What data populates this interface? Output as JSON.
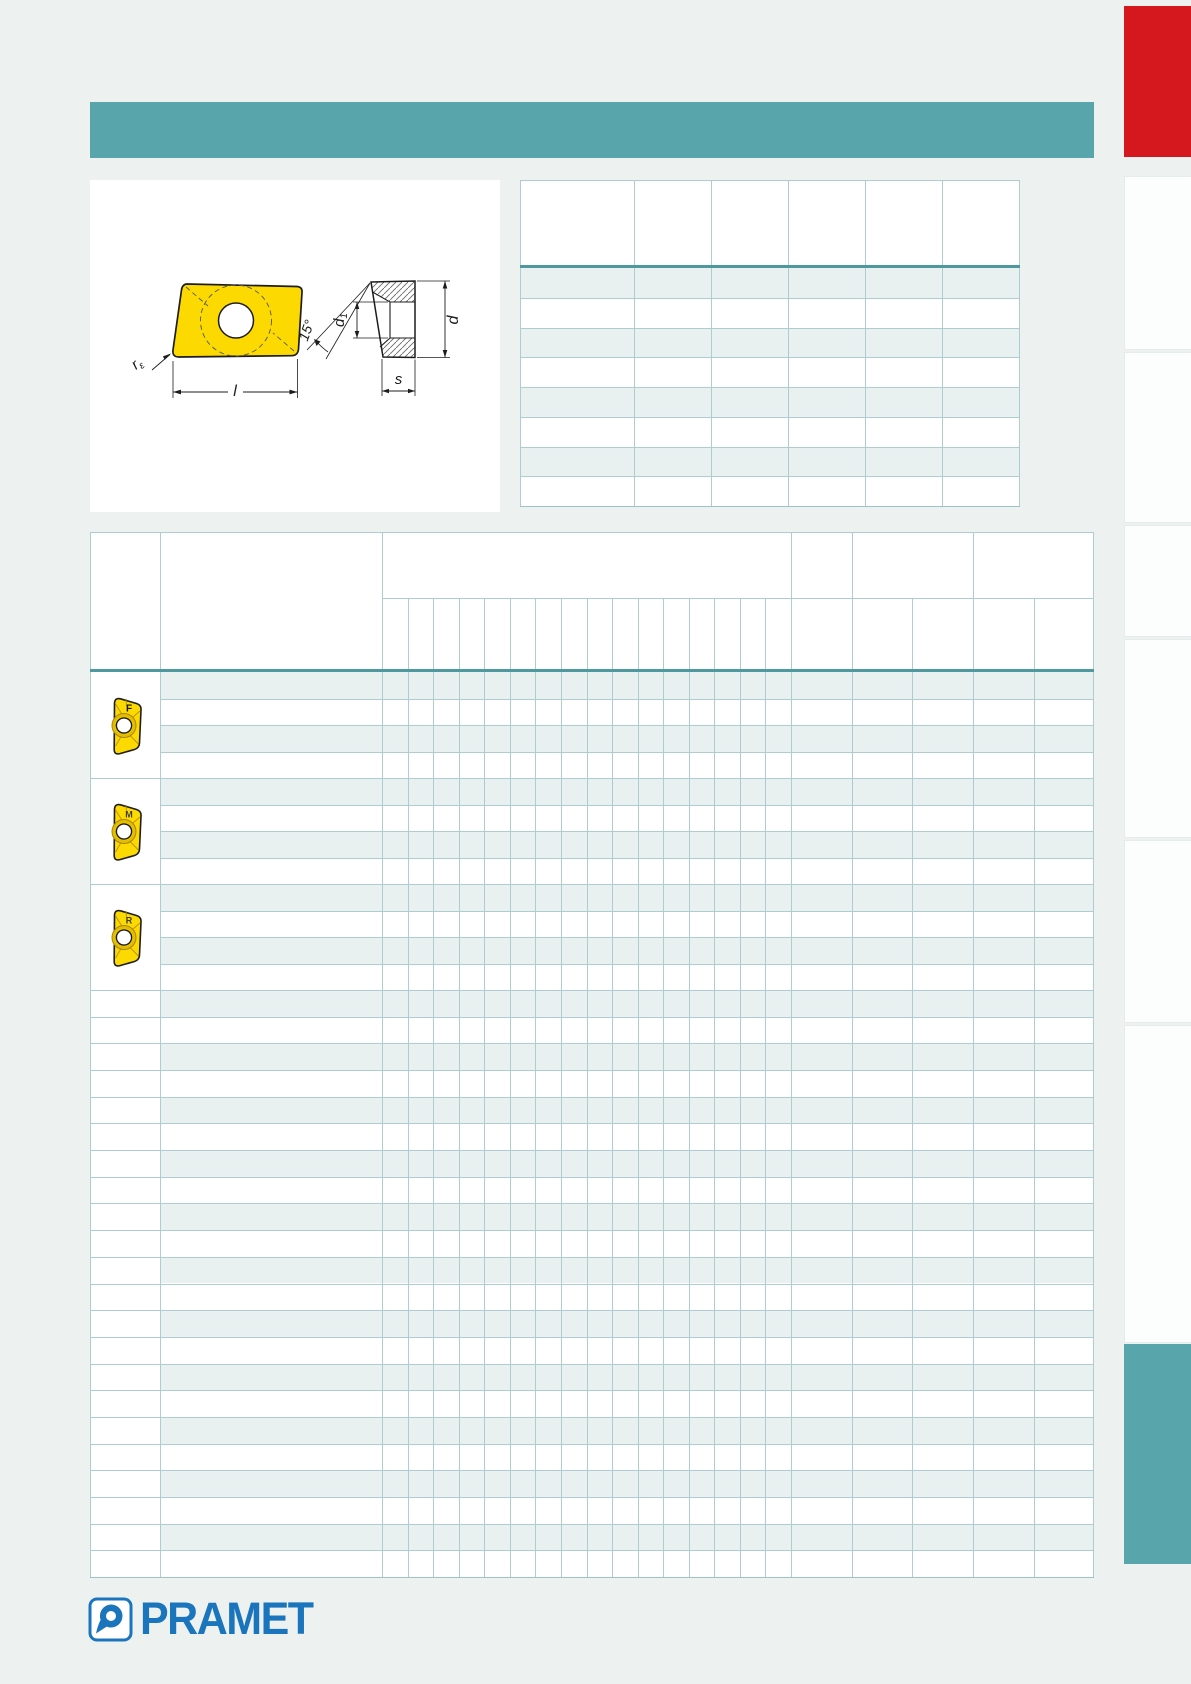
{
  "colors": {
    "page_background": "#edf2f1",
    "teal_accent": "#58a5ab",
    "teal_header_rule": "#4e99a0",
    "grid_line": "#aecdd2",
    "row_tint": "#e9f1f0",
    "red_tab": "#d5171e",
    "side_tab_white": "#fcfdfd",
    "insert_yellow": "#fcd900",
    "logo_blue": "#1b75bc"
  },
  "drawing": {
    "labels": {
      "corner_radius_base": "r",
      "corner_radius_sub": "ε",
      "length": "l",
      "angle": "15°",
      "hole_diameter_base": "d",
      "hole_diameter_sub": "1",
      "outer_diameter": "d",
      "thickness": "s"
    }
  },
  "dimensions_table": {
    "column_count": 6,
    "data_row_count": 8
  },
  "main_table": {
    "insert_groups": [
      {
        "chipbreaker_letter": "F",
        "row_count": 4
      },
      {
        "chipbreaker_letter": "M",
        "row_count": 4
      },
      {
        "chipbreaker_letter": "R",
        "row_count": 4
      }
    ],
    "plain_row_count": 22,
    "narrow_column_count": 16
  },
  "logo": {
    "text": "PRAMET"
  }
}
